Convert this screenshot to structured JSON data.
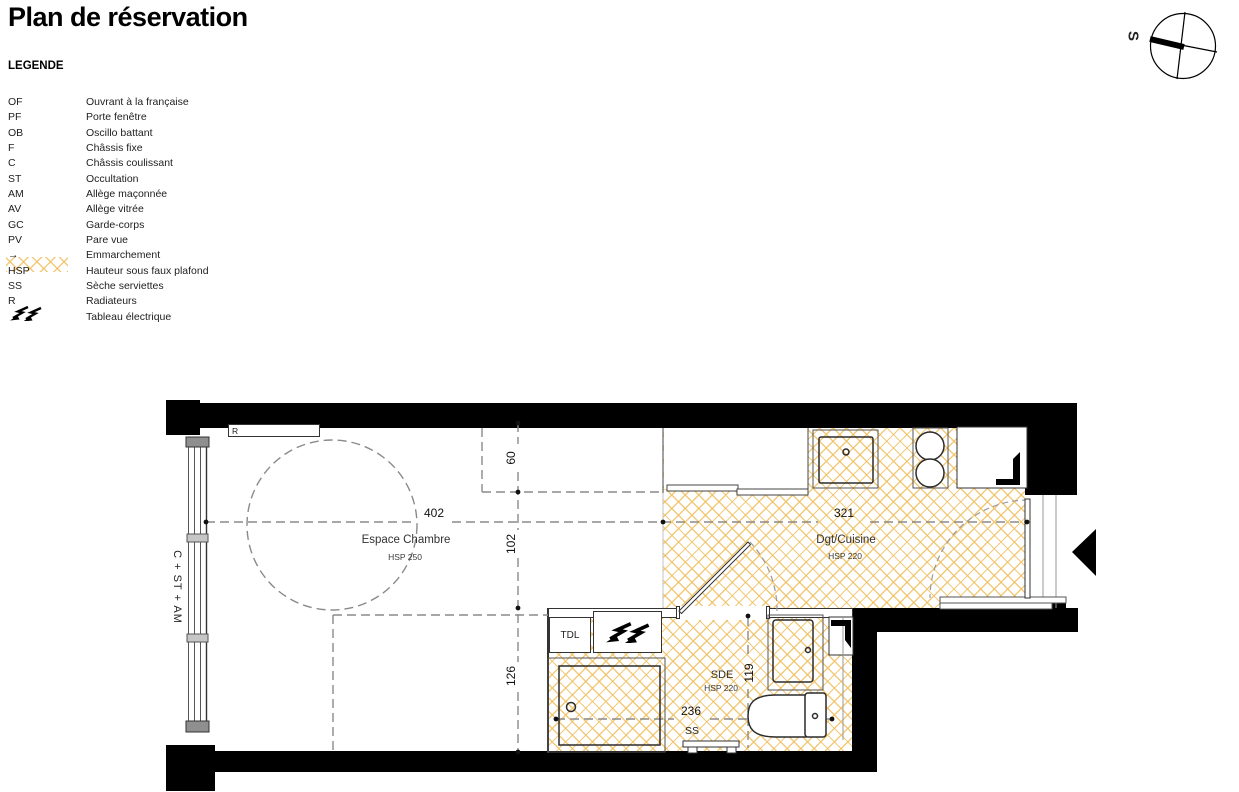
{
  "title": "Plan de réservation",
  "legend": {
    "heading": "LEGENDE",
    "items": [
      {
        "abbr": "OF",
        "desc": "Ouvrant à la française"
      },
      {
        "abbr": "PF",
        "desc": "Porte fenêtre"
      },
      {
        "abbr": "OB",
        "desc": "Oscillo battant"
      },
      {
        "abbr": "F",
        "desc": "Châssis fixe"
      },
      {
        "abbr": "C",
        "desc": "Châssis coulissant"
      },
      {
        "abbr": "ST",
        "desc": "Occultation"
      },
      {
        "abbr": "AM",
        "desc": "Allège maçonnée"
      },
      {
        "abbr": "AV",
        "desc": "Allège vitrée"
      },
      {
        "abbr": "GC",
        "desc": "Garde-corps"
      },
      {
        "abbr": "PV",
        "desc": "Pare vue"
      },
      {
        "abbr": "→",
        "desc": "Emmarchement"
      },
      {
        "abbr": "HSP",
        "desc": "Hauteur sous faux plafond"
      },
      {
        "abbr": "SS",
        "desc": "Sèche serviettes"
      },
      {
        "abbr": "R",
        "desc": "Radiateurs"
      },
      {
        "abbr": "",
        "desc": "Tableau électrique"
      }
    ]
  },
  "compass": {
    "south_label": "S"
  },
  "plan": {
    "rooms": [
      {
        "name": "Espace Chambre",
        "hsp": "HSP 250"
      },
      {
        "name": "Dgt/Cuisine",
        "hsp": "HSP 220"
      },
      {
        "name": "SDE",
        "hsp": "HSP 220"
      }
    ],
    "labels": {
      "radiator": "R",
      "window": "C + ST + AM",
      "electrical_cupboard": "TDL",
      "towel_dryer": "SS"
    },
    "dimensions": {
      "chambre_width": "402",
      "cuisine_width": "321",
      "entry_depth": "60",
      "mid_depth": "102",
      "lower_depth": "126",
      "sde_depth": "119",
      "sde_width": "236"
    },
    "colors": {
      "hatch": "#f0c164",
      "wall": "#000000",
      "dashed": "#8a8a8a"
    }
  }
}
